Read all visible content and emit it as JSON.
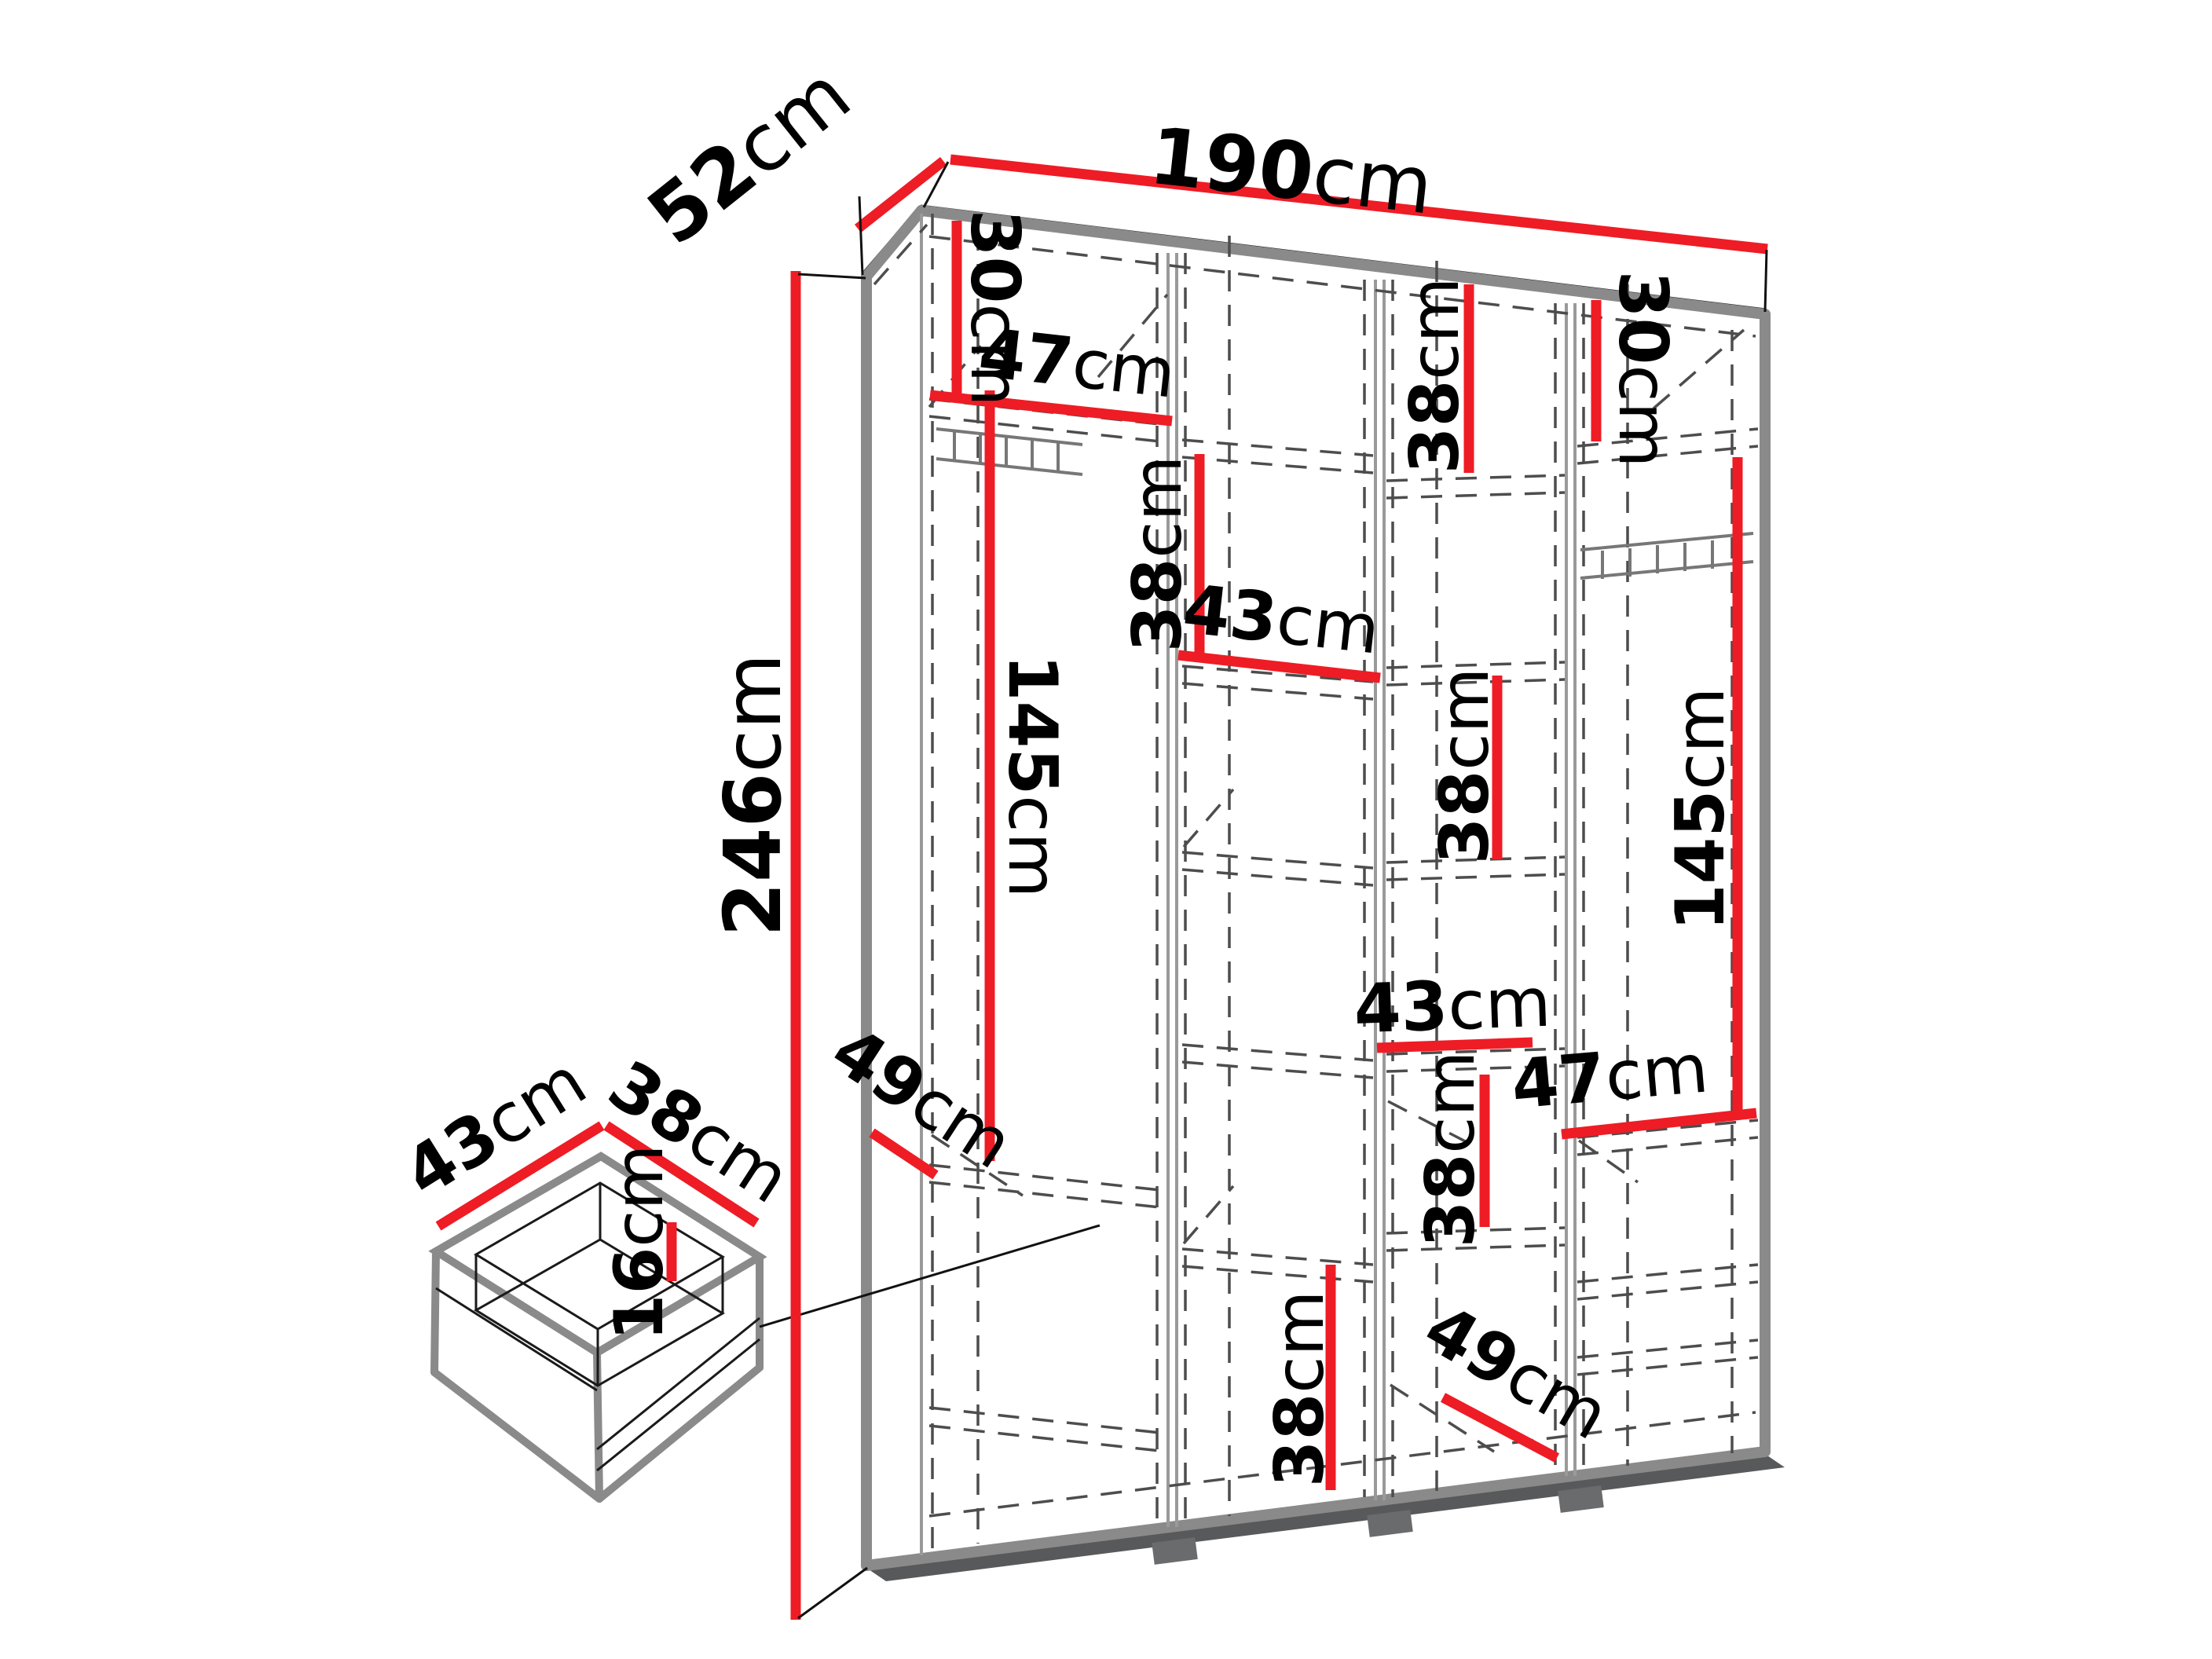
{
  "diagram": {
    "title": "wardrobe-dimension-diagram",
    "unit": "cm",
    "accent_color": "#ee1c25",
    "outline_color": "#8a8a8a",
    "dash_color": "#4d4d4d",
    "overall": {
      "width": "190cm",
      "depth": "52cm",
      "height": "246cm"
    },
    "drawer_detail": {
      "width": "43cm",
      "depth": "38cm",
      "height": "16cm"
    }
  },
  "labels": [
    {
      "value": "190",
      "unit": "cm",
      "role": "overall-width"
    },
    {
      "value": "52",
      "unit": "cm",
      "role": "overall-depth"
    },
    {
      "value": "246",
      "unit": "cm",
      "role": "overall-height"
    },
    {
      "value": "30",
      "unit": "cm",
      "role": "col1-top-shelf-height"
    },
    {
      "value": "47",
      "unit": "cm",
      "role": "col1-shelf-width"
    },
    {
      "value": "145",
      "unit": "cm",
      "role": "col1-hanging-height"
    },
    {
      "value": "38",
      "unit": "cm",
      "role": "col2-top-section-height"
    },
    {
      "value": "43",
      "unit": "cm",
      "role": "col2-shelf-width"
    },
    {
      "value": "38",
      "unit": "cm",
      "role": "col3-top-section-height"
    },
    {
      "value": "30",
      "unit": "cm",
      "role": "col4-top-shelf-height"
    },
    {
      "value": "38",
      "unit": "cm",
      "role": "col3-middle-section-height"
    },
    {
      "value": "145",
      "unit": "cm",
      "role": "col4-hanging-height"
    },
    {
      "value": "43",
      "unit": "cm",
      "role": "col3-shelf-width"
    },
    {
      "value": "47",
      "unit": "cm",
      "role": "col4-shelf-width"
    },
    {
      "value": "38",
      "unit": "cm",
      "role": "col3-lower-section-height"
    },
    {
      "value": "49",
      "unit": "cm",
      "role": "col1-lower-depth"
    },
    {
      "value": "49",
      "unit": "cm",
      "role": "col3-bottom-depth"
    },
    {
      "value": "38",
      "unit": "cm",
      "role": "col2-bottom-section-height"
    },
    {
      "value": "43",
      "unit": "cm",
      "role": "drawer-width"
    },
    {
      "value": "38",
      "unit": "cm",
      "role": "drawer-depth"
    },
    {
      "value": "16",
      "unit": "cm",
      "role": "drawer-height"
    }
  ]
}
